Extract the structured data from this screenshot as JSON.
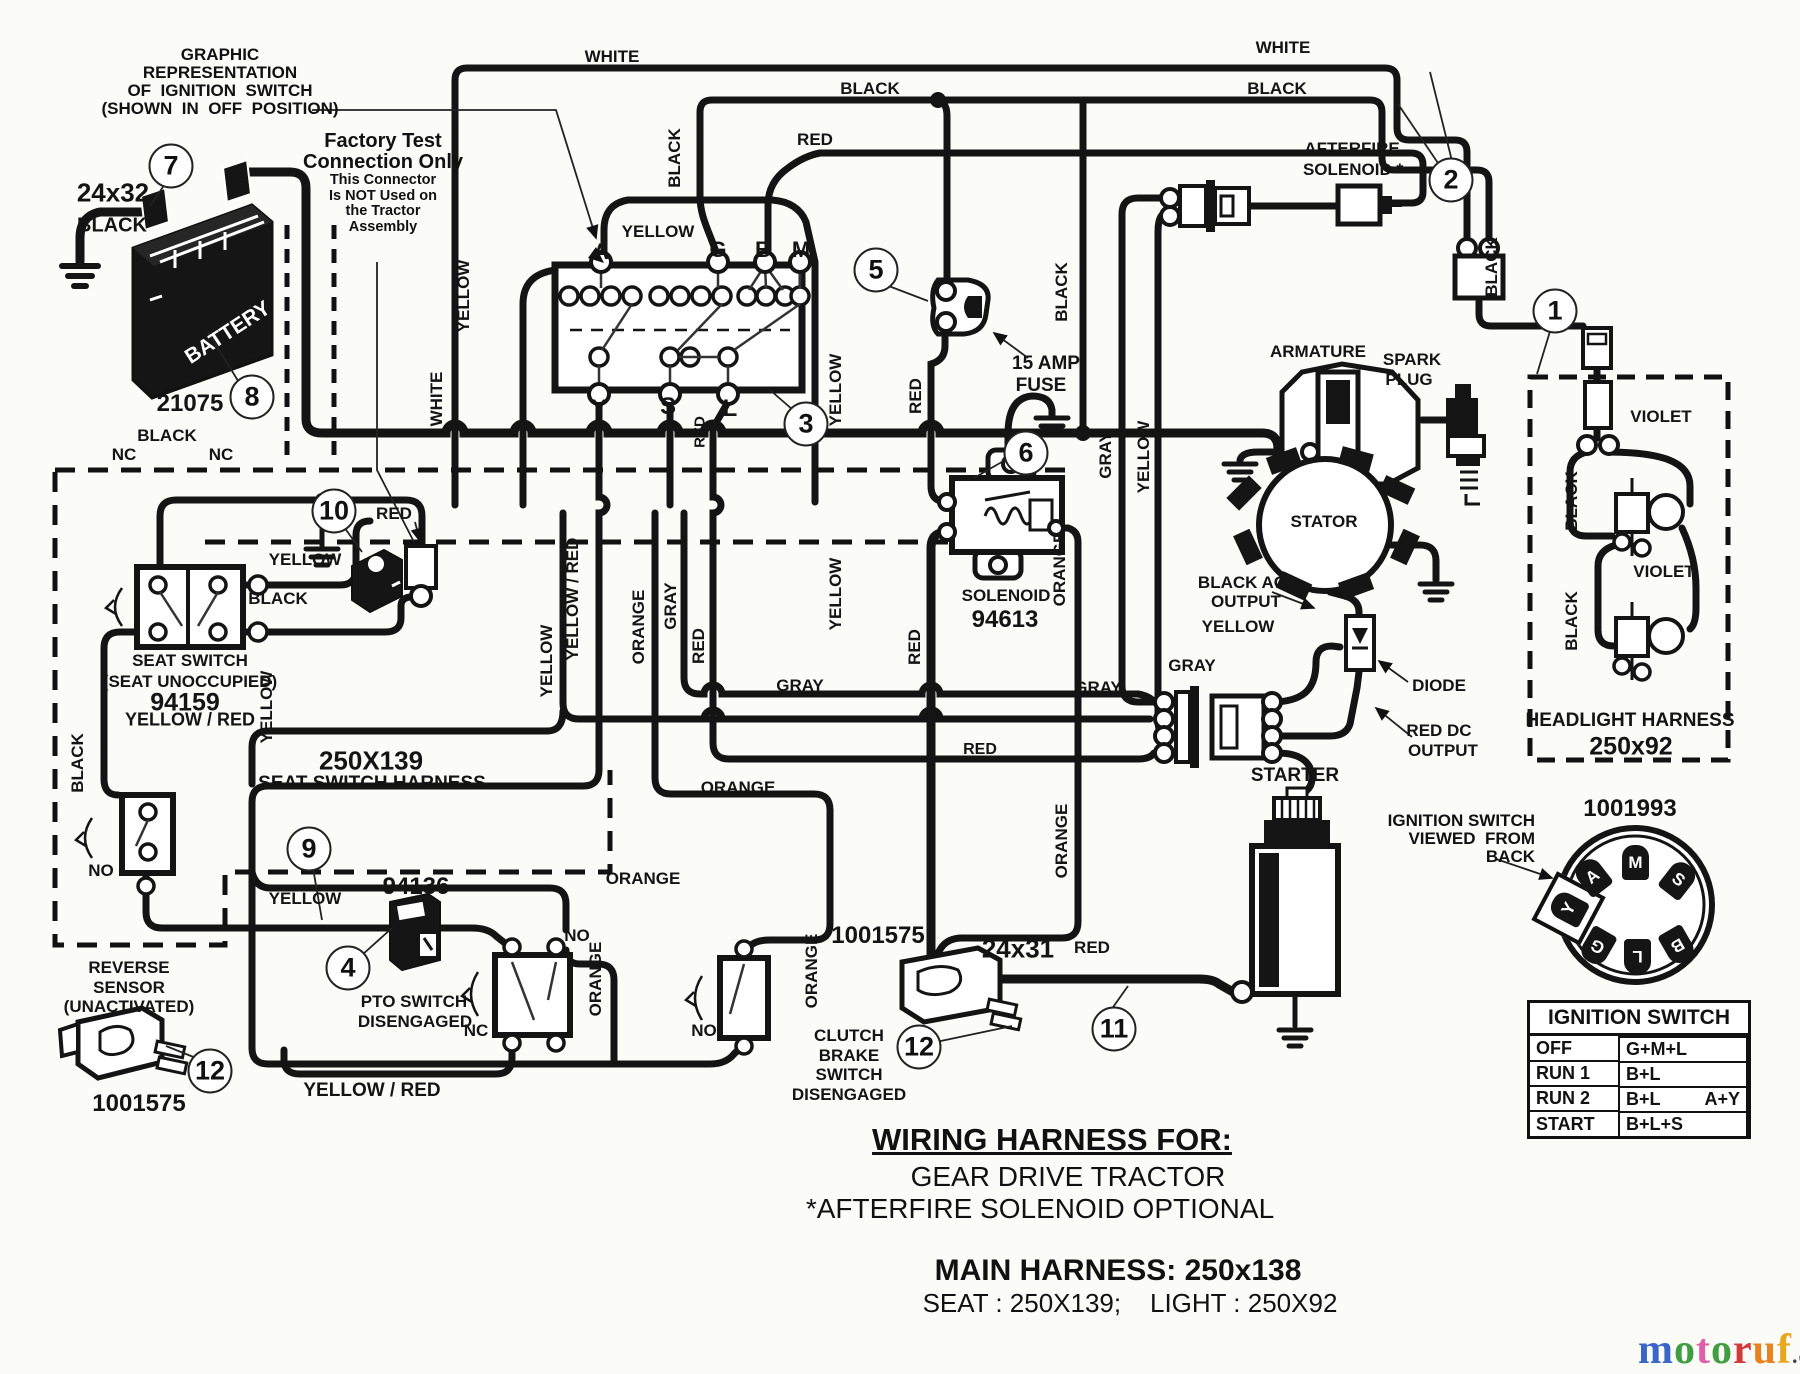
{
  "doc": {
    "type": "wiring-diagram",
    "footer": {
      "title": "WIRING HARNESS FOR:",
      "sub1": "GEAR DRIVE TRACTOR",
      "sub2": "*AFTERFIRE SOLENOID OPTIONAL",
      "main": "MAIN HARNESS: 250x138",
      "seat_light": "SEAT : 250X139;    LIGHT : 250X92"
    }
  },
  "notes": {
    "graphic": [
      "GRAPHIC",
      "REPRESENTATION",
      "OF  IGNITION  SWITCH",
      "(SHOWN  IN  OFF  POSITION)"
    ],
    "factory_bold": [
      "Factory Test",
      "Connection Only"
    ],
    "factory_small": [
      "This Connector",
      "Is NOT Used on",
      "the Tractor",
      "Assembly"
    ],
    "ign_back": [
      "IGNITION SWITCH",
      "VIEWED  FROM",
      "BACK"
    ]
  },
  "table": {
    "header": "IGNITION SWITCH",
    "rows": [
      {
        "pos": "OFF",
        "circuit": "G+M+L",
        "extra": ""
      },
      {
        "pos": "RUN 1",
        "circuit": "B+L",
        "extra": ""
      },
      {
        "pos": "RUN 2",
        "circuit": "B+L",
        "extra": "A+Y"
      },
      {
        "pos": "START",
        "circuit": "B+L+S",
        "extra": ""
      }
    ]
  },
  "rear_switch": {
    "part_number": "1001993",
    "terminals": [
      {
        "l": "M",
        "x": 1635,
        "y": 862,
        "r": 0,
        "hl": false
      },
      {
        "l": "A",
        "x": 1592,
        "y": 876,
        "r": -38,
        "hl": false
      },
      {
        "l": "S",
        "x": 1678,
        "y": 879,
        "r": 38,
        "hl": false
      },
      {
        "l": "Y",
        "x": 1568,
        "y": 908,
        "r": -62,
        "hl": true
      },
      {
        "l": "G",
        "x": 1597,
        "y": 946,
        "r": 210,
        "hl": false
      },
      {
        "l": "L",
        "x": 1637,
        "y": 956,
        "r": 180,
        "hl": false
      },
      {
        "l": "B",
        "x": 1677,
        "y": 945,
        "r": 150,
        "hl": false
      }
    ]
  },
  "labels": {
    "h": [
      {
        "t": "WHITE",
        "x": 612,
        "y": 57
      },
      {
        "t": "BLACK",
        "x": 870,
        "y": 89
      },
      {
        "t": "WHITE",
        "x": 1283,
        "y": 48
      },
      {
        "t": "BLACK",
        "x": 1277,
        "y": 89
      },
      {
        "t": "RED",
        "x": 815,
        "y": 140
      },
      {
        "t": "YELLOW",
        "x": 658,
        "y": 232
      },
      {
        "t": "24x32",
        "x": 113,
        "y": 193,
        "s": 26
      },
      {
        "t": "BLACK",
        "x": 112,
        "y": 226,
        "s": 20
      },
      {
        "t": "A",
        "x": 601,
        "y": 252,
        "s": 22
      },
      {
        "t": "G",
        "x": 718,
        "y": 250,
        "s": 22
      },
      {
        "t": "B",
        "x": 763,
        "y": 250,
        "s": 22
      },
      {
        "t": "M",
        "x": 801,
        "y": 250,
        "s": 22
      },
      {
        "t": "Y",
        "x": 599,
        "y": 409,
        "s": 24
      },
      {
        "t": "S",
        "x": 668,
        "y": 407,
        "s": 24
      },
      {
        "t": "L",
        "x": 730,
        "y": 409,
        "s": 24
      },
      {
        "t": "15 AMP",
        "x": 1046,
        "y": 364,
        "s": 19
      },
      {
        "t": "FUSE",
        "x": 1041,
        "y": 386,
        "s": 19
      },
      {
        "t": "AFTERFIRE",
        "x": 1352,
        "y": 149
      },
      {
        "t": "SOLENOID *",
        "x": 1353,
        "y": 170
      },
      {
        "t": "ARMATURE",
        "x": 1318,
        "y": 352
      },
      {
        "t": "SPARK",
        "x": 1412,
        "y": 360
      },
      {
        "t": "PLUG",
        "x": 1409,
        "y": 380
      },
      {
        "t": "VIOLET",
        "x": 1661,
        "y": 417
      },
      {
        "t": "STATOR",
        "x": 1324,
        "y": 522
      },
      {
        "t": "VIOLET",
        "x": 1664,
        "y": 572
      },
      {
        "t": "HEADLIGHT HARNESS",
        "x": 1630,
        "y": 721,
        "s": 19
      },
      {
        "t": "250x92",
        "x": 1631,
        "y": 747,
        "s": 25
      },
      {
        "t": "BLACK AC",
        "x": 1242,
        "y": 583
      },
      {
        "t": "OUTPUT",
        "x": 1246,
        "y": 602
      },
      {
        "t": "YELLOW",
        "x": 1238,
        "y": 627
      },
      {
        "t": "GRAY",
        "x": 1192,
        "y": 666
      },
      {
        "t": "GRAY",
        "x": 1098,
        "y": 688
      },
      {
        "t": "GRAY",
        "x": 800,
        "y": 686
      },
      {
        "t": "DIODE",
        "x": 1439,
        "y": 686
      },
      {
        "t": "RED DC",
        "x": 1439,
        "y": 731
      },
      {
        "t": "OUTPUT",
        "x": 1443,
        "y": 751
      },
      {
        "t": "STARTER",
        "x": 1295,
        "y": 776,
        "s": 19
      },
      {
        "t": "RED",
        "x": 980,
        "y": 750,
        "s": 16
      },
      {
        "t": "ORANGE",
        "x": 738,
        "y": 788
      },
      {
        "t": "ORANGE",
        "x": 643,
        "y": 879
      },
      {
        "t": "24x31",
        "x": 1018,
        "y": 949,
        "s": 26
      },
      {
        "t": "RED",
        "x": 1092,
        "y": 948
      },
      {
        "t": "BLACK",
        "x": 167,
        "y": 436
      },
      {
        "t": "RED",
        "x": 394,
        "y": 514
      },
      {
        "t": "NC",
        "x": 124,
        "y": 455
      },
      {
        "t": "NC",
        "x": 221,
        "y": 455
      },
      {
        "t": "BLACK",
        "x": 278,
        "y": 599
      },
      {
        "t": "YELLOW",
        "x": 305,
        "y": 560
      },
      {
        "t": "SEAT SWITCH",
        "x": 190,
        "y": 661
      },
      {
        "t": "(SEAT UNOCCUPIED)",
        "x": 190,
        "y": 682
      },
      {
        "t": "94159",
        "x": 185,
        "y": 703,
        "s": 25
      },
      {
        "t": "YELLOW / RED",
        "x": 190,
        "y": 720,
        "s": 18
      },
      {
        "t": "250X139",
        "x": 371,
        "y": 761,
        "s": 26
      },
      {
        "t": "SEAT SWITCH HARNESS",
        "x": 372,
        "y": 784,
        "s": 19
      },
      {
        "t": "YELLOW",
        "x": 305,
        "y": 899
      },
      {
        "t": "NO",
        "x": 101,
        "y": 871
      },
      {
        "t": "REVERSE",
        "x": 129,
        "y": 968
      },
      {
        "t": "SENSOR",
        "x": 129,
        "y": 988
      },
      {
        "t": "(UNACTIVATED)",
        "x": 129,
        "y": 1007
      },
      {
        "t": "1001575",
        "x": 139,
        "y": 1104,
        "s": 24
      },
      {
        "t": "94136",
        "x": 416,
        "y": 887,
        "s": 24
      },
      {
        "t": "PTO SWITCH",
        "x": 414,
        "y": 1002
      },
      {
        "t": "DISENGAGED",
        "x": 415,
        "y": 1022
      },
      {
        "t": "NO",
        "x": 577,
        "y": 936
      },
      {
        "t": "NC",
        "x": 476,
        "y": 1031
      },
      {
        "t": "NO",
        "x": 704,
        "y": 1031
      },
      {
        "t": "YELLOW / RED",
        "x": 372,
        "y": 1091,
        "s": 19
      },
      {
        "t": "1001575",
        "x": 878,
        "y": 936,
        "s": 24
      },
      {
        "t": "CLUTCH",
        "x": 849,
        "y": 1036
      },
      {
        "t": "BRAKE",
        "x": 849,
        "y": 1056
      },
      {
        "t": "SWITCH",
        "x": 849,
        "y": 1075
      },
      {
        "t": "DISENGAGED",
        "x": 849,
        "y": 1095
      },
      {
        "t": "SOLENOID",
        "x": 1006,
        "y": 596
      },
      {
        "t": "94613",
        "x": 1005,
        "y": 620,
        "s": 24
      },
      {
        "t": "1001993",
        "x": 1630,
        "y": 809,
        "s": 24
      },
      {
        "t": "BATTERY",
        "x": 228,
        "y": 333,
        "s": 21,
        "r": -33,
        "c": "#ffffff"
      },
      {
        "t": "21075",
        "x": 190,
        "y": 404,
        "s": 24
      }
    ],
    "v": [
      {
        "t": "BLACK",
        "x": 675,
        "y": 158
      },
      {
        "t": "YELLOW",
        "x": 464,
        "y": 296
      },
      {
        "t": "WHITE",
        "x": 437,
        "y": 399
      },
      {
        "t": "YELLOW",
        "x": 836,
        "y": 390
      },
      {
        "t": "RED",
        "x": 700,
        "y": 432,
        "s": 15
      },
      {
        "t": "RED",
        "x": 916,
        "y": 396
      },
      {
        "t": "BLACK",
        "x": 1062,
        "y": 292
      },
      {
        "t": "GRAY",
        "x": 1106,
        "y": 455
      },
      {
        "t": "YELLOW",
        "x": 1144,
        "y": 457
      },
      {
        "t": "ORANGE",
        "x": 1060,
        "y": 569
      },
      {
        "t": "YELLOW / RED",
        "x": 573,
        "y": 599
      },
      {
        "t": "YELLOW",
        "x": 547,
        "y": 661
      },
      {
        "t": "ORANGE",
        "x": 639,
        "y": 627
      },
      {
        "t": "GRAY",
        "x": 671,
        "y": 606
      },
      {
        "t": "RED",
        "x": 699,
        "y": 646
      },
      {
        "t": "YELLOW",
        "x": 836,
        "y": 594
      },
      {
        "t": "RED",
        "x": 915,
        "y": 647
      },
      {
        "t": "ORANGE",
        "x": 1062,
        "y": 841
      },
      {
        "t": "ORANGE",
        "x": 812,
        "y": 971
      },
      {
        "t": "ORANGE",
        "x": 596,
        "y": 979
      },
      {
        "t": "YELLOW",
        "x": 267,
        "y": 707
      },
      {
        "t": "BLACK",
        "x": 78,
        "y": 763
      },
      {
        "t": "BLACK",
        "x": 1492,
        "y": 267
      },
      {
        "t": "BLACK",
        "x": 1572,
        "y": 501
      },
      {
        "t": "BLACK",
        "x": 1572,
        "y": 621
      }
    ]
  },
  "callouts": [
    {
      "n": "7",
      "x": 171,
      "y": 166
    },
    {
      "n": "8",
      "x": 252,
      "y": 397
    },
    {
      "n": "10",
      "x": 334,
      "y": 511
    },
    {
      "n": "9",
      "x": 309,
      "y": 849
    },
    {
      "n": "12",
      "x": 210,
      "y": 1071
    },
    {
      "n": "4",
      "x": 348,
      "y": 968
    },
    {
      "n": "12",
      "x": 919,
      "y": 1047
    },
    {
      "n": "11",
      "x": 1114,
      "y": 1029
    },
    {
      "n": "5",
      "x": 876,
      "y": 270
    },
    {
      "n": "3",
      "x": 806,
      "y": 424
    },
    {
      "n": "6",
      "x": 1026,
      "y": 453
    },
    {
      "n": "2",
      "x": 1451,
      "y": 180
    },
    {
      "n": "1",
      "x": 1555,
      "y": 311
    }
  ],
  "watermark": {
    "letters": [
      {
        "ch": "m",
        "color": "#3a66c8"
      },
      {
        "ch": "o",
        "color": "#3f9e3f"
      },
      {
        "ch": "t",
        "color": "#e060a8"
      },
      {
        "ch": "o",
        "color": "#3f9e3f"
      },
      {
        "ch": "r",
        "color": "#d03a3a"
      },
      {
        "ch": "u",
        "color": "#e8821e"
      },
      {
        "ch": "f",
        "color": "#e8a81e"
      }
    ],
    "suffix": ".de"
  }
}
